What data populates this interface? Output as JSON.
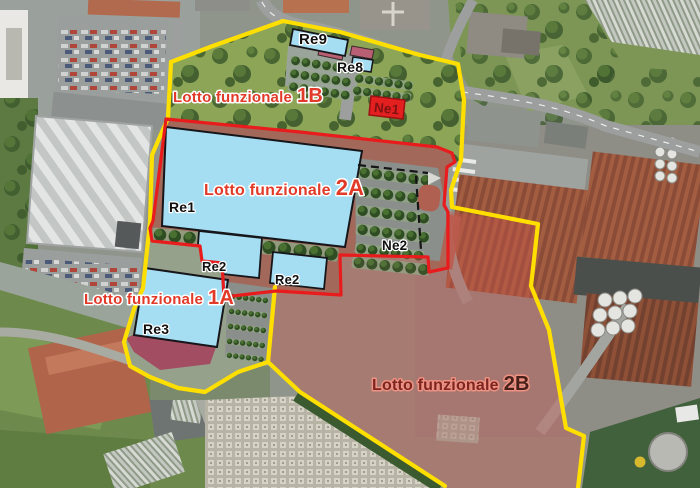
{
  "map": {
    "title": "Aerial masterplan with functional lots",
    "lots": [
      {
        "name": "Lotto funzionale",
        "code": "1B",
        "boundary_color": "#ffdf00"
      },
      {
        "name": "Lotto funzionale",
        "code": "2A",
        "boundary_color": "#e81c1c"
      },
      {
        "name": "Lotto funzionale",
        "code": "1A",
        "boundary_color": "#ffdf00"
      },
      {
        "name": "Lotto funzionale",
        "code": "2B",
        "boundary_color": "#ffdf00",
        "fill_color": "rgba(205,85,75,0.38)"
      }
    ],
    "buildings": [
      {
        "code": "Re9",
        "fill": "#a5ddf2"
      },
      {
        "code": "Re8",
        "fill": "#a5ddf2"
      },
      {
        "code": "Ne1",
        "fill": "#e31f1f"
      },
      {
        "code": "Re1",
        "fill": "#a5ddf2"
      },
      {
        "code": "Re2",
        "fill": "#a5ddf2"
      },
      {
        "code": "Re2",
        "fill": "#a5ddf2"
      },
      {
        "code": "Re3",
        "fill": "#a5ddf2"
      },
      {
        "code": "Ne2",
        "fill": ""
      }
    ],
    "colors": {
      "boundary_yellow": "#ffdf00",
      "boundary_red": "#e81c1c",
      "building_blue": "#a5ddf2",
      "building_red": "#e31f1f",
      "accent_pink": "#b85f74",
      "maroon_area": "#a34d62",
      "label_red": "#e23a28",
      "label_dark_red": "#7e2620"
    }
  }
}
